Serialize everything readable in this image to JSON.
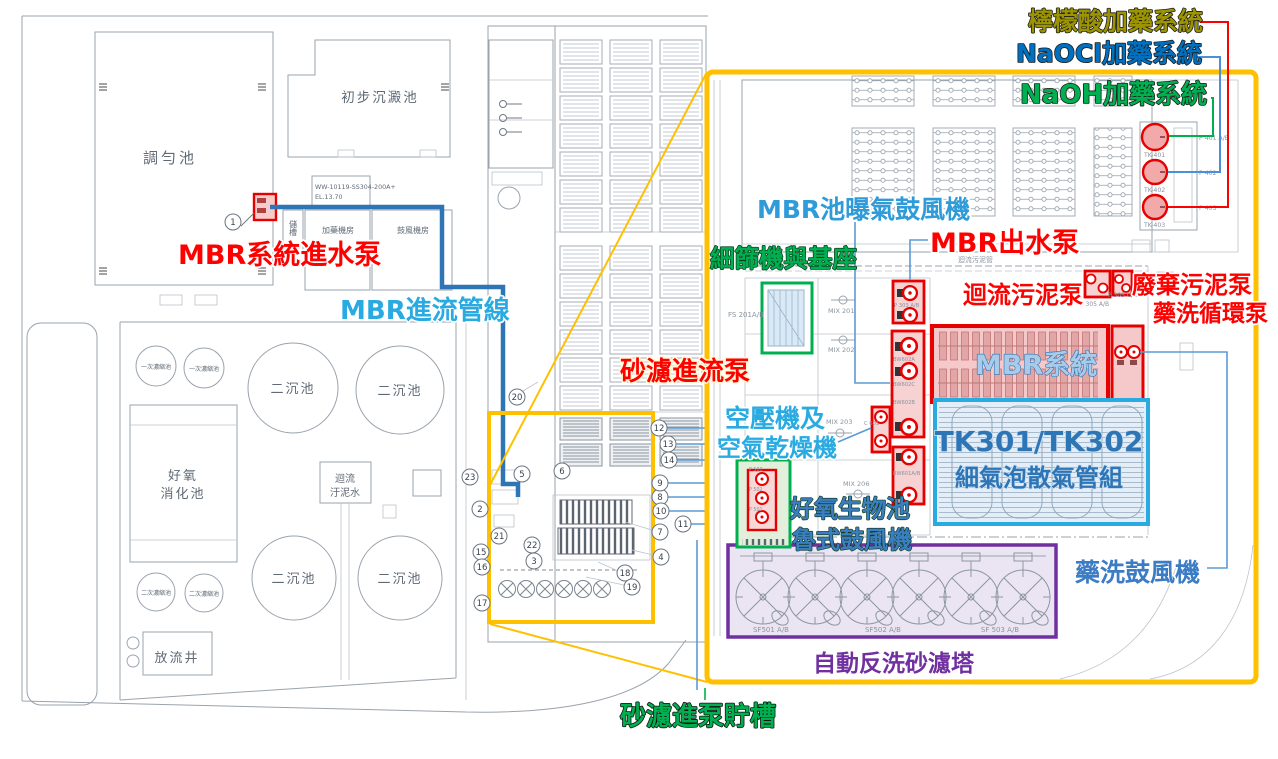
{
  "colors": {
    "highlight_box": "#FFC000",
    "red_highlight": "#E60000",
    "green_highlight": "#00B050",
    "cyan_highlight": "#29ABE2",
    "blue_pipe": "#2E75B6",
    "purple_highlight": "#7030A0",
    "olive_label": "#9C9400",
    "naocl_blue": "#0070C0"
  },
  "overlay": {
    "citric_acid_dosing": "檸檬酸加藥系統",
    "naocl_dosing": "NaOCl加藥系統",
    "naoh_dosing": "NaOH加藥系統",
    "mbr_aeration_blower": "MBR池曝氣鼓風機",
    "mbr_outlet_pump": "MBR出水泵",
    "fine_screen_base": "細篩機與基座",
    "return_sludge_pump": "迴流污泥泵",
    "waste_sludge_pump": "廢棄污泥泵",
    "cip_circulation_pump": "藥洗循環泵",
    "mbr_system": "MBR系統",
    "sand_filter_feed_pump": "砂濾進流泵",
    "air_compressor_l1": "空壓機及",
    "air_compressor_l2": "空氣乾燥機",
    "tk_tanks_l1": "TK301/TK302",
    "tk_tanks_l2": "細氣泡散氣管組",
    "aerobic_blower_l1": "好氧生物池",
    "aerobic_blower_l2": "魯式鼓風機",
    "cip_blower": "藥洗鼓風機",
    "auto_backwash_sand_filter": "自動反洗砂濾塔",
    "sand_filter_feed_tank": "砂濾進泵貯槽",
    "mbr_feed_pump": "MBR系統進水泵",
    "mbr_inflow_pipe": "MBR進流管線"
  },
  "site": {
    "equalization_tank": "調勻池",
    "primary_sedimentation_tank": "初步沉澱池",
    "pipe_spec_l1": "WW-10119-SS304-200A+",
    "pipe_spec_l2": "EL.13.70",
    "storage_tank": "儲槽",
    "dosing_room": "加藥機房",
    "blower_room": "鼓風機房",
    "primary_thickener": "一次濃縮池",
    "secondary_clarifier": "二沉池",
    "aerobic_digester_l1": "好氧",
    "aerobic_digester_l2": "消化池",
    "return_sludge_l1": "迴流",
    "return_sludge_l2": "汙泥水",
    "secondary_thickener": "二次濃縮池",
    "outfall_well": "放流井"
  },
  "detail": {
    "return_sludge_pipe": "迴流污泥管",
    "fs_screen": "FS 201A/B",
    "mix201": "MIX 201",
    "mix202": "MIX 202",
    "mix203": "MIX 203",
    "mix206": "MIX 206",
    "p303": "P 303 A/B",
    "bw602a": "BW602A",
    "bw602c": "BW602C",
    "bw602b": "BW602B",
    "c601": "C 601",
    "bw601": "BW601A/B",
    "p305ab": "P 305 A/B",
    "p305cd": "P 305 C/D",
    "tk401": "TK-401",
    "tk402": "TK-402",
    "tk403": "TK-403",
    "p401": "P 401 A/B",
    "p402": "P 402",
    "p403": "P 403",
    "p503": "P 503",
    "p502": "P 502",
    "p501": "P 501",
    "sf501": "SF501 A/B",
    "sf502": "SF502 A/B",
    "sf503": "SF 503 A/B"
  },
  "callouts": {
    "c1": "1",
    "c2": "2",
    "c3": "3",
    "c4": "4",
    "c5": "5",
    "c6": "6",
    "c7": "7",
    "c8": "8",
    "c9": "9",
    "c10": "10",
    "c11": "11",
    "c12": "12",
    "c13": "13",
    "c14": "14",
    "c15": "15",
    "c16": "16",
    "c17": "17",
    "c18": "18",
    "c19": "19",
    "c20": "20",
    "c21": "21",
    "c22": "22",
    "c23": "23"
  }
}
